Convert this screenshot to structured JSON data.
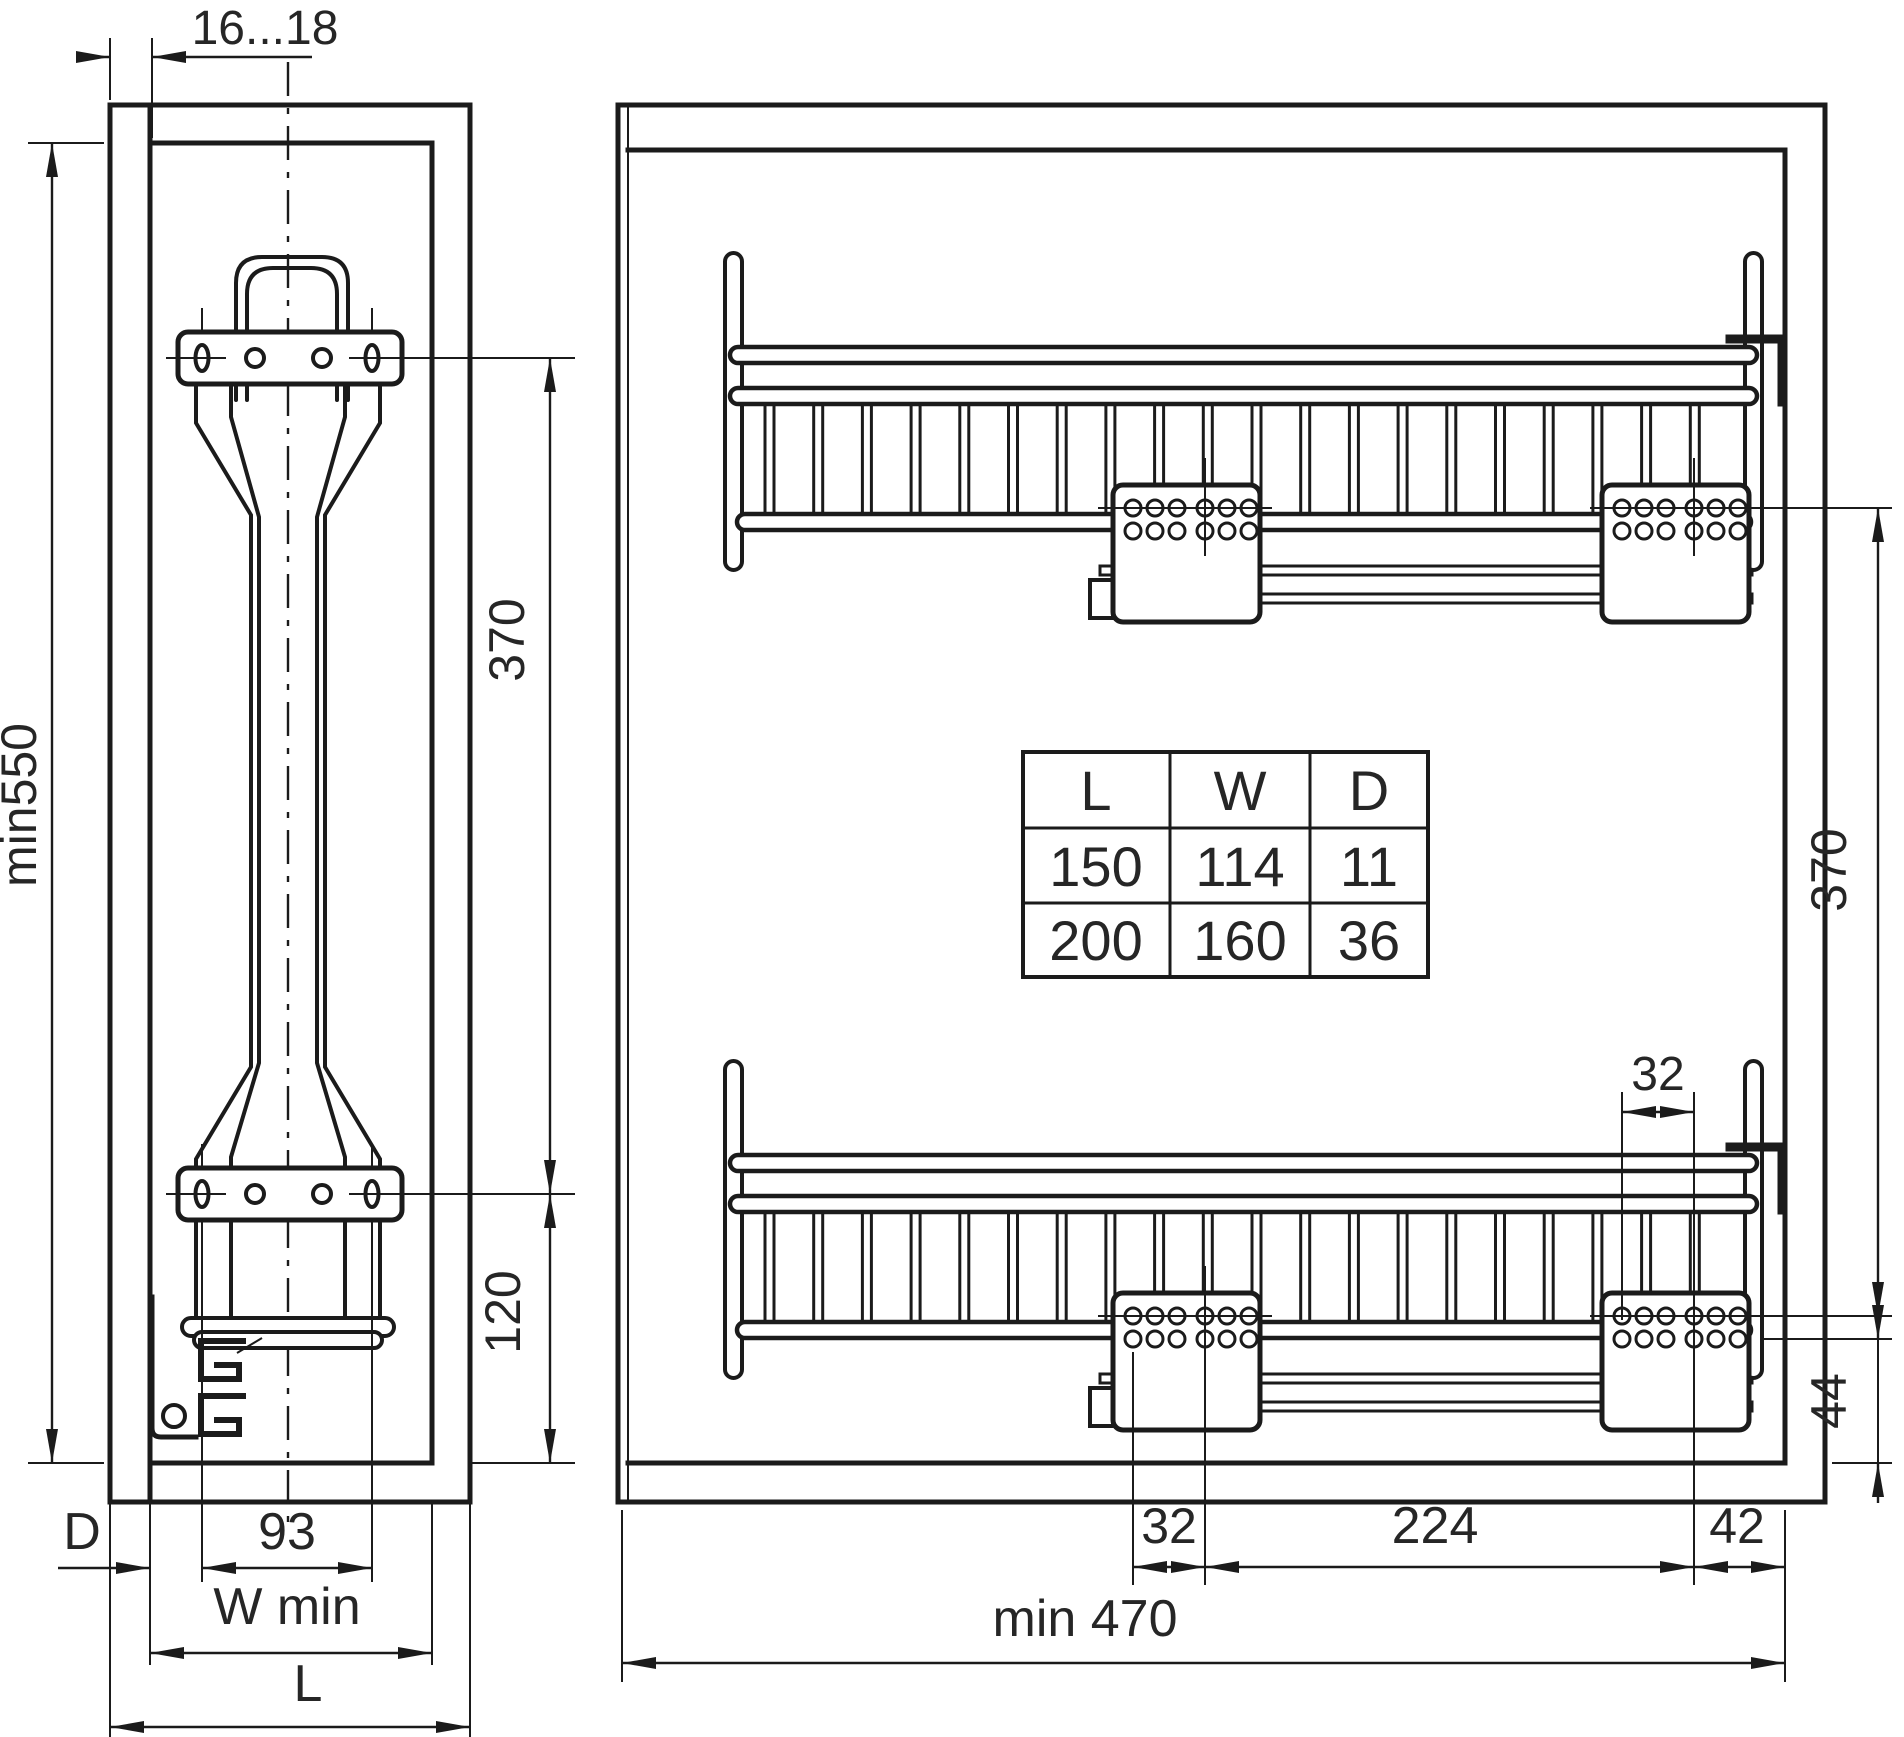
{
  "drawing": {
    "left_view": {
      "dim_door_thickness": "16...18",
      "dim_cabinet_height": "min550",
      "dim_bracket_span": "370",
      "dim_bottom_span": "120",
      "dim_depth_label": "D",
      "dim_slot_spacing": "93",
      "dim_width_min": "W min",
      "dim_length": "L"
    },
    "right_view": {
      "dim_hole_pitch_top": "32",
      "dim_vertical_span": "370",
      "dim_bottom_offset": "44",
      "dim_hole_pitch_bottom": "32",
      "dim_runner_span": "224",
      "dim_back_offset": "42",
      "dim_depth_min": "min 470"
    },
    "size_table": {
      "headers": [
        "L",
        "W",
        "D"
      ],
      "rows": [
        [
          "150",
          "114",
          "11"
        ],
        [
          "200",
          "160",
          "36"
        ]
      ]
    }
  }
}
